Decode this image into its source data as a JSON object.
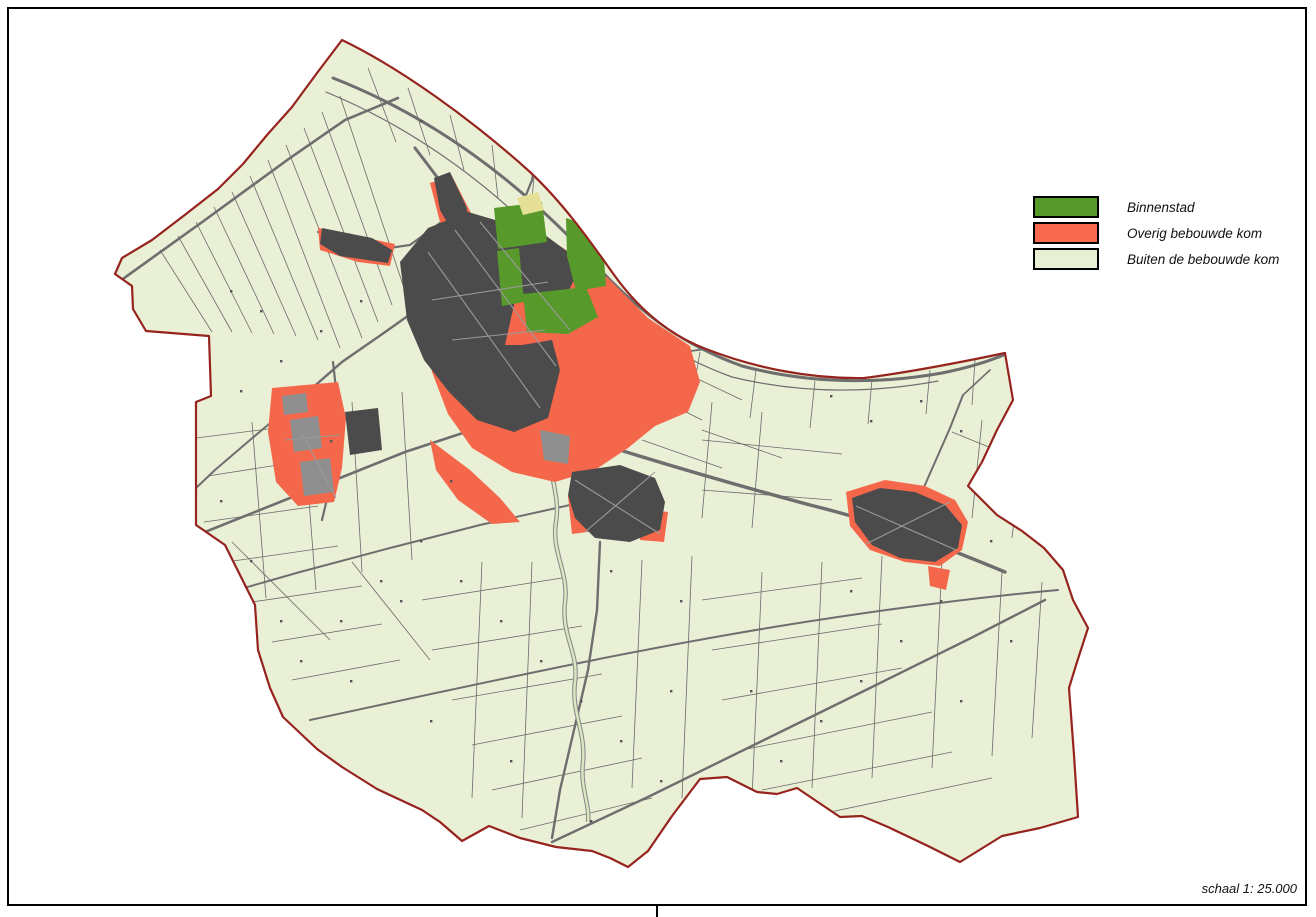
{
  "sheet": {
    "width": 1316,
    "height": 917,
    "background": "#ffffff"
  },
  "frame": {
    "x": 8,
    "y": 8,
    "width": 1298,
    "height": 897,
    "stroke": "#000000",
    "stroke_width": 2,
    "divider_x": 657
  },
  "legend": {
    "items": [
      {
        "label": "Binnenstad",
        "color": "#579A2B"
      },
      {
        "label": "Overig bebouwde kom",
        "color": "#F8694F"
      },
      {
        "label": "Buiten de bebouwde kom",
        "color": "#E7EFD4"
      }
    ]
  },
  "scale": {
    "label": "schaal 1: 25.000"
  },
  "map": {
    "colors": {
      "outside": "#ffffff",
      "rural_fill": "#E9F0D6",
      "boundary_stroke": "#96231E",
      "parcel_line": "#6a6a6a",
      "road": "#6e6e6e",
      "built_up_red": "#F5674B",
      "building_dark": "#4b4b4b",
      "binnenstad_green": "#57992B",
      "gray_area": "#8f8f8f",
      "sand_yellow": "#E6E096",
      "river_casing": "#8a8a8a",
      "river_water": "#dce7c2",
      "street_line": "#9a9a9a",
      "speck": "#555555"
    },
    "boundary_path": "M 342,40 C 400,68 470,118 530,172 C 562,202 588,238 612,272 C 640,312 672,336 706,349 C 755,368 810,379 864,378 C 912,372 962,362 1005,353 L 1013,400 L 997,430 L 982,462 L 968,486 L 997,515 L 1022,531 L 1044,548 L 1063,570 L 1073,600 L 1088,628 L 1077,662 L 1069,688 L 1074,755 L 1078,817 L 1040,828 L 1002,836 L 960,862 L 928,846 L 888,827 L 862,816 L 840,817 L 797,788 L 777,794 L 757,792 L 727,777 L 700,779 L 672,816 L 648,851 L 628,867 L 610,858 L 592,851 L 556,847 L 520,838 L 489,826 L 462,841 L 440,822 L 422,810 L 377,789 L 342,767 L 317,749 L 283,717 L 270,688 L 258,650 L 255,605 L 225,545 L 196,525 L 196,402 L 211,396 L 209,336 L 146,331 L 133,309 L 132,286 L 115,274 L 122,258 L 152,240 L 186,214 L 218,189 L 243,164 L 267,135 L 292,107 L 317,73 Z",
    "minor_lines": [
      [
        160,
        250,
        212,
        332
      ],
      [
        178,
        236,
        232,
        332
      ],
      [
        196,
        222,
        252,
        333
      ],
      [
        214,
        207,
        274,
        334
      ],
      [
        232,
        192,
        296,
        336
      ],
      [
        250,
        176,
        318,
        340
      ],
      [
        268,
        160,
        340,
        348
      ],
      [
        286,
        145,
        362,
        338
      ],
      [
        304,
        128,
        378,
        322
      ],
      [
        322,
        112,
        392,
        305
      ],
      [
        340,
        96,
        404,
        288
      ],
      [
        368,
        68,
        396,
        142
      ],
      [
        408,
        88,
        430,
        155
      ],
      [
        450,
        115,
        464,
        170
      ],
      [
        492,
        145,
        498,
        198
      ],
      [
        534,
        178,
        530,
        218
      ],
      [
        700,
        352,
        692,
        398
      ],
      [
        756,
        370,
        750,
        418
      ],
      [
        815,
        381,
        810,
        428
      ],
      [
        872,
        379,
        868,
        424
      ],
      [
        930,
        370,
        926,
        414
      ],
      [
        975,
        360,
        972,
        405
      ],
      [
        196,
        438,
        308,
        424
      ],
      [
        208,
        476,
        322,
        458
      ],
      [
        204,
        522,
        318,
        506
      ],
      [
        226,
        562,
        338,
        546
      ],
      [
        252,
        602,
        362,
        586
      ],
      [
        272,
        642,
        382,
        624
      ],
      [
        292,
        680,
        400,
        660
      ],
      [
        252,
        422,
        266,
        598
      ],
      [
        302,
        412,
        316,
        590
      ],
      [
        352,
        402,
        362,
        572
      ],
      [
        402,
        392,
        412,
        560
      ],
      [
        232,
        542,
        330,
        640
      ],
      [
        352,
        562,
        430,
        660
      ],
      [
        422,
        600,
        562,
        578
      ],
      [
        432,
        650,
        582,
        626
      ],
      [
        452,
        700,
        602,
        674
      ],
      [
        472,
        745,
        622,
        716
      ],
      [
        492,
        790,
        642,
        758
      ],
      [
        520,
        830,
        652,
        798
      ],
      [
        482,
        562,
        472,
        798
      ],
      [
        532,
        562,
        522,
        818
      ],
      [
        642,
        560,
        632,
        788
      ],
      [
        692,
        556,
        682,
        798
      ],
      [
        702,
        600,
        862,
        578
      ],
      [
        712,
        650,
        882,
        624
      ],
      [
        722,
        700,
        902,
        668
      ],
      [
        742,
        750,
        932,
        712
      ],
      [
        762,
        790,
        952,
        752
      ],
      [
        792,
        820,
        992,
        778
      ],
      [
        762,
        572,
        752,
        798
      ],
      [
        822,
        562,
        812,
        788
      ],
      [
        882,
        556,
        872,
        778
      ],
      [
        942,
        562,
        932,
        768
      ],
      [
        1002,
        572,
        992,
        756
      ],
      [
        1042,
        582,
        1032,
        738
      ],
      [
        982,
        420,
        972,
        518
      ],
      [
        1022,
        452,
        1012,
        538
      ],
      [
        702,
        440,
        842,
        454
      ],
      [
        702,
        490,
        832,
        500
      ],
      [
        952,
        432,
        1040,
        468
      ],
      [
        712,
        402,
        702,
        518
      ],
      [
        762,
        412,
        752,
        528
      ],
      [
        622,
        380,
        702,
        420
      ],
      [
        662,
        362,
        742,
        400
      ],
      [
        702,
        430,
        782,
        458
      ],
      [
        642,
        440,
        722,
        468
      ]
    ],
    "roads": [
      {
        "d": "M 333,78 C 430,116 512,176 584,252 C 638,314 686,346 742,366 C 806,383 876,385 942,373 C 972,367 992,360 1006,354",
        "w": 3
      },
      {
        "d": "M 326,92 C 418,130 498,190 566,264 C 622,322 674,356 732,377 C 798,393 868,394 938,381",
        "w": 1.2
      },
      {
        "d": "M 120,281 L 205,220 L 290,158 L 345,120 L 398,98",
        "w": 2.6
      },
      {
        "d": "M 415,148 C 455,200 500,260 527,322 C 543,362 552,408 556,452",
        "w": 3
      },
      {
        "d": "M 433,298 L 388,330 L 342,362 L 310,390 L 288,408",
        "w": 2.4
      },
      {
        "d": "M 333,362 L 340,425 L 332,478 L 322,520",
        "w": 2.2
      },
      {
        "d": "M 205,532 L 300,494 L 405,452 L 472,430 L 523,415",
        "w": 2.6
      },
      {
        "d": "M 520,418 C 610,448 710,478 810,505 C 880,522 940,545 1005,572",
        "w": 3.4
      },
      {
        "d": "M 600,542 L 597,610 L 588,670 L 574,730 L 560,790 L 552,838",
        "w": 2.4
      },
      {
        "d": "M 310,720 C 460,688 620,652 780,626 C 880,610 970,598 1058,590",
        "w": 2
      },
      {
        "d": "M 552,842 L 650,796 L 760,742 L 870,688 L 975,636 L 1045,600",
        "w": 2.4
      },
      {
        "d": "M 903,535 L 928,478 L 950,428 L 963,395",
        "w": 2
      },
      {
        "d": "M 570,505 L 480,525 L 390,548 L 300,572 L 230,592",
        "w": 2
      },
      {
        "d": "M 455,212 L 410,245 L 362,252 L 318,232",
        "w": 2.2
      },
      {
        "d": "M 527,322 L 600,345 L 660,355 L 706,349",
        "w": 1.8
      },
      {
        "d": "M 500,250 L 520,210 L 532,180 L 538,150 L 534,120 L 525,96",
        "w": 2.2
      },
      {
        "d": "M 288,408 L 250,440 L 215,470 L 196,488",
        "w": 2
      },
      {
        "d": "M 963,395 L 990,370",
        "w": 1.6
      }
    ],
    "river": {
      "d": "M 553,440 C 545,472 561,492 556,522 C 551,552 569,572 565,602 C 561,636 579,652 575,682 C 571,712 586,732 583,762 C 580,788 590,804 588,822",
      "casing_w": 4.5,
      "water_w": 2.4
    },
    "red_areas": [
      "M 272,388 L 338,382 L 346,418 L 342,468 L 334,502 L 298,506 L 276,482 L 268,432 Z",
      "M 318,228 L 395,244 L 390,266 L 358,262 L 320,250 Z",
      "M 428,258 L 470,236 L 510,230 L 560,246 L 608,278 L 648,318 L 690,346 L 700,382 L 688,412 L 655,426 L 628,448 L 595,470 L 555,482 L 512,472 L 472,448 L 448,414 L 432,372 L 424,314 Z",
      "M 430,183 L 452,176 L 472,215 L 480,250 L 462,258 L 440,222 Z",
      "M 430,440 L 470,470 L 500,498 L 520,522 L 492,524 L 458,500 L 436,470 Z",
      "M 568,496 L 600,488 L 602,530 L 572,534 Z",
      "M 638,508 L 668,512 L 664,542 L 640,540 Z",
      "M 846,492 L 885,480 L 925,486 L 955,500 L 968,522 L 962,550 L 940,566 L 905,562 L 870,550 L 850,526 Z",
      "M 928,566 L 950,570 L 946,590 L 930,586 Z"
    ],
    "gray_areas": [
      "M 290,420 L 318,416 L 322,448 L 294,452 Z",
      "M 300,462 L 330,458 L 334,492 L 304,496 Z",
      "M 282,396 L 306,393 L 308,412 L 284,415 Z",
      "M 540,430 L 570,436 L 568,464 L 544,460 Z"
    ],
    "dark_areas": [
      "M 400,262 L 428,228 L 468,212 L 502,222 L 512,245 L 514,305 L 505,345 L 522,345 L 552,340 L 560,370 L 548,418 L 514,432 L 477,420 L 449,392 L 424,360 L 407,320 Z",
      "M 512,242 L 545,235 L 568,252 L 575,278 L 566,296 L 540,302 L 518,296 L 510,266 Z",
      "M 434,178 L 450,172 L 466,206 L 472,232 L 456,238 L 440,210 Z",
      "M 322,228 L 372,238 L 392,250 L 388,263 L 340,256 L 320,244 Z",
      "M 345,412 L 378,408 L 382,450 L 350,455 Z",
      "M 572,472 L 620,465 L 655,478 L 665,502 L 660,530 L 630,542 L 595,538 L 575,518 L 568,495 Z",
      "M 852,498 L 880,488 L 915,492 L 945,505 L 962,525 L 958,548 L 935,562 L 900,558 L 872,545 L 855,522 Z"
    ],
    "green_areas": [
      "M 494,208 L 542,202 L 547,242 L 498,249 Z",
      "M 566,218 L 602,230 L 606,286 L 576,291 L 567,256 Z",
      "M 497,251 L 519,248 L 524,302 L 502,306 Z",
      "M 523,294 L 586,287 L 598,317 L 568,334 L 527,332 Z"
    ],
    "yellow_areas": [
      "M 517,198 L 538,192 L 544,210 L 523,215 Z"
    ],
    "street_lines": [
      [
        428,
        252,
        540,
        408
      ],
      [
        455,
        230,
        556,
        366
      ],
      [
        480,
        222,
        570,
        330
      ],
      [
        432,
        300,
        548,
        282
      ],
      [
        452,
        340,
        545,
        330
      ],
      [
        575,
        480,
        660,
        534
      ],
      [
        585,
        532,
        655,
        472
      ],
      [
        856,
        506,
        956,
        550
      ],
      [
        866,
        544,
        950,
        502
      ],
      [
        300,
        430,
        336,
        498
      ],
      [
        285,
        440,
        340,
        435
      ]
    ],
    "specks": [
      [
        230,
        290
      ],
      [
        260,
        310
      ],
      [
        200,
        360
      ],
      [
        240,
        390
      ],
      [
        280,
        360
      ],
      [
        320,
        330
      ],
      [
        360,
        300
      ],
      [
        390,
        250
      ],
      [
        420,
        120
      ],
      [
        470,
        95
      ],
      [
        520,
        120
      ],
      [
        560,
        140
      ],
      [
        610,
        180
      ],
      [
        640,
        230
      ],
      [
        680,
        280
      ],
      [
        730,
        330
      ],
      [
        780,
        360
      ],
      [
        830,
        395
      ],
      [
        870,
        420
      ],
      [
        920,
        400
      ],
      [
        960,
        430
      ],
      [
        1000,
        470
      ],
      [
        1030,
        520
      ],
      [
        990,
        540
      ],
      [
        940,
        600
      ],
      [
        900,
        640
      ],
      [
        860,
        680
      ],
      [
        820,
        720
      ],
      [
        780,
        760
      ],
      [
        740,
        800
      ],
      [
        700,
        820
      ],
      [
        660,
        780
      ],
      [
        620,
        740
      ],
      [
        580,
        700
      ],
      [
        540,
        660
      ],
      [
        500,
        620
      ],
      [
        460,
        580
      ],
      [
        420,
        540
      ],
      [
        380,
        580
      ],
      [
        340,
        620
      ],
      [
        300,
        660
      ],
      [
        280,
        620
      ],
      [
        250,
        560
      ],
      [
        220,
        500
      ],
      [
        350,
        680
      ],
      [
        430,
        720
      ],
      [
        510,
        760
      ],
      [
        590,
        820
      ],
      [
        670,
        690
      ],
      [
        750,
        690
      ],
      [
        850,
        590
      ],
      [
        960,
        700
      ],
      [
        1010,
        640
      ],
      [
        680,
        600
      ],
      [
        610,
        570
      ],
      [
        450,
        480
      ],
      [
        400,
        600
      ],
      [
        330,
        440
      ]
    ]
  }
}
